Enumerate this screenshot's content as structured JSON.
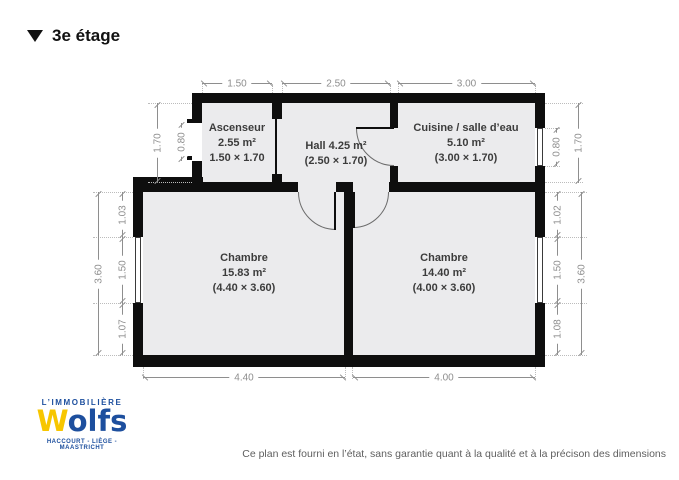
{
  "header": {
    "floor_label": "3e étage"
  },
  "plan": {
    "rooms": {
      "ascenseur": {
        "name": "Ascenseur",
        "area": "2.55 m²",
        "size": "1.50 × 1.70"
      },
      "hall": {
        "title": "Hall 4.25 m²",
        "size": "(2.50 × 1.70)"
      },
      "cuisine": {
        "name": "Cuisine / salle d’eau",
        "area": "5.10 m²",
        "size": "(3.00 × 1.70)"
      },
      "chambre_left": {
        "name": "Chambre",
        "area": "15.83 m²",
        "size": "(4.40 × 3.60)"
      },
      "chambre_right": {
        "name": "Chambre",
        "area": "14.40 m²",
        "size": "(4.00 × 3.60)"
      }
    },
    "dimensions": {
      "top": [
        "1.50",
        "2.50",
        "3.00"
      ],
      "bottom": [
        "4.40",
        "4.00"
      ],
      "upper_left": {
        "outer": "1.70",
        "door": "0.80"
      },
      "upper_right": {
        "window": "0.80",
        "outer": "1.70"
      },
      "left": {
        "outer": "3.60",
        "segments": [
          "1.03",
          "1.50",
          "1.07"
        ]
      },
      "right": {
        "outer": "3.60",
        "segments": [
          "1.02",
          "1.50",
          "1.08"
        ]
      }
    }
  },
  "logo": {
    "name_top": "L’IMMOBILIÈRE",
    "wordmark_w": "W",
    "wordmark_rest": "olfs",
    "cities": "HACCOURT - LIÈGE - MAASTRICHT"
  },
  "footer": {
    "disclaimer": "Ce plan est fourni en l’état, sans garantie quant à la qualité et à la précison des dimensions"
  },
  "colors": {
    "wall": "#0e0e0e",
    "room_fill": "#ebebed",
    "dimension": "#8e8e8e",
    "title": "#111111",
    "logo_blue": "#1d4f9e",
    "logo_yellow": "#f7c600",
    "disclaimer": "#5f5f5f"
  }
}
